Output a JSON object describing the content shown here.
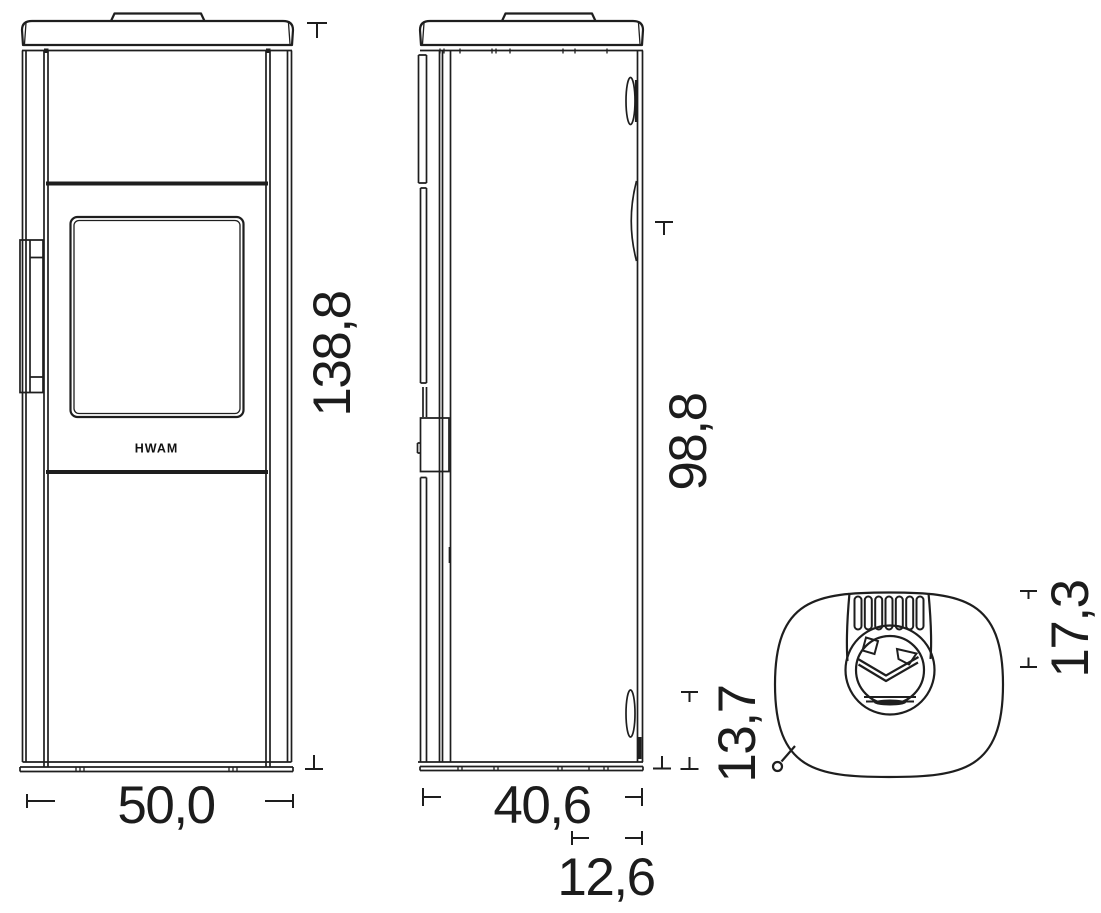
{
  "drawing": {
    "type": "technical-dimension-drawing",
    "subject": "wood-burning stove, three orthographic views",
    "logo_text": "HWAM",
    "colors": {
      "line": "#1e1e1e",
      "background": "#ffffff"
    },
    "views": {
      "front": {
        "name": "front view",
        "label_width": "50,0",
        "label_height": "138,8"
      },
      "side": {
        "name": "side view",
        "label_depth": "40,6",
        "label_body_height": "98,8",
        "label_rear_lower": "13,7",
        "label_rear_offset": "12,6"
      },
      "top": {
        "name": "top view",
        "label_flue_offset": "17,3"
      }
    }
  }
}
